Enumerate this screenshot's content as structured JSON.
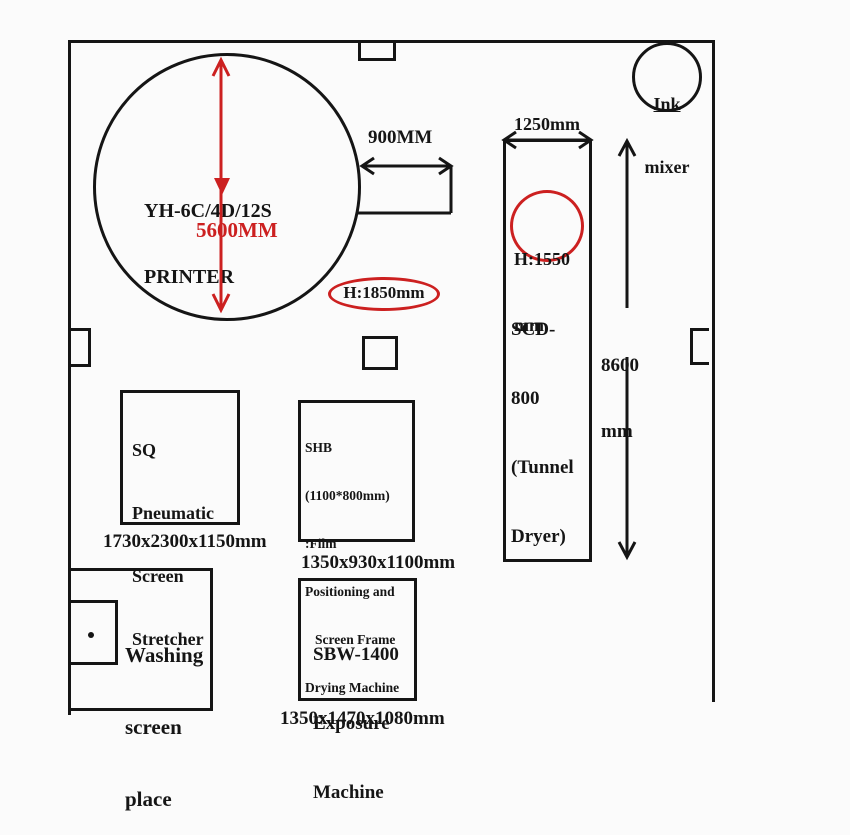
{
  "colors": {
    "line": "#151515",
    "red": "#cc2020",
    "background": "#fbfbfb"
  },
  "printer": {
    "name_line1": "YH-6C/4D/12S",
    "name_line2": "PRINTER",
    "diameter_dim": "5600MM",
    "height_dim": "H:1850mm",
    "side_width_dim": "900MM"
  },
  "ink_mixer": {
    "line1": "Ink",
    "line2": "mixer"
  },
  "tunnel_dryer": {
    "width_dim": "1250mm",
    "height_line1": "H:1550",
    "height_line2": "mm",
    "name_line1": "SCD-",
    "name_line2": "800",
    "name_line3": "(Tunnel",
    "name_line4": "Dryer)",
    "length_line1": "8600",
    "length_line2": "mm"
  },
  "screen_stretcher": {
    "line1": "SQ",
    "line2": "Pneumatic",
    "line3": "Screen",
    "line4": "Stretcher",
    "dimensions": "1730x2300x1150mm"
  },
  "shb_machine": {
    "line1": "SHB",
    "line2": "(1100*800mm)",
    "line3": ":Film",
    "line4": "Positioning and",
    "line5": "Screen Frame",
    "line6": "Drying Machine",
    "dimensions": "1350x930x1100mm"
  },
  "exposure_machine": {
    "line1": "SBW-1400",
    "line2": "Exposure",
    "line3": "Machine",
    "dimensions": "1350x1470x1080mm"
  },
  "washing_area": {
    "line1": "Washing",
    "line2": "screen",
    "line3": "place"
  }
}
